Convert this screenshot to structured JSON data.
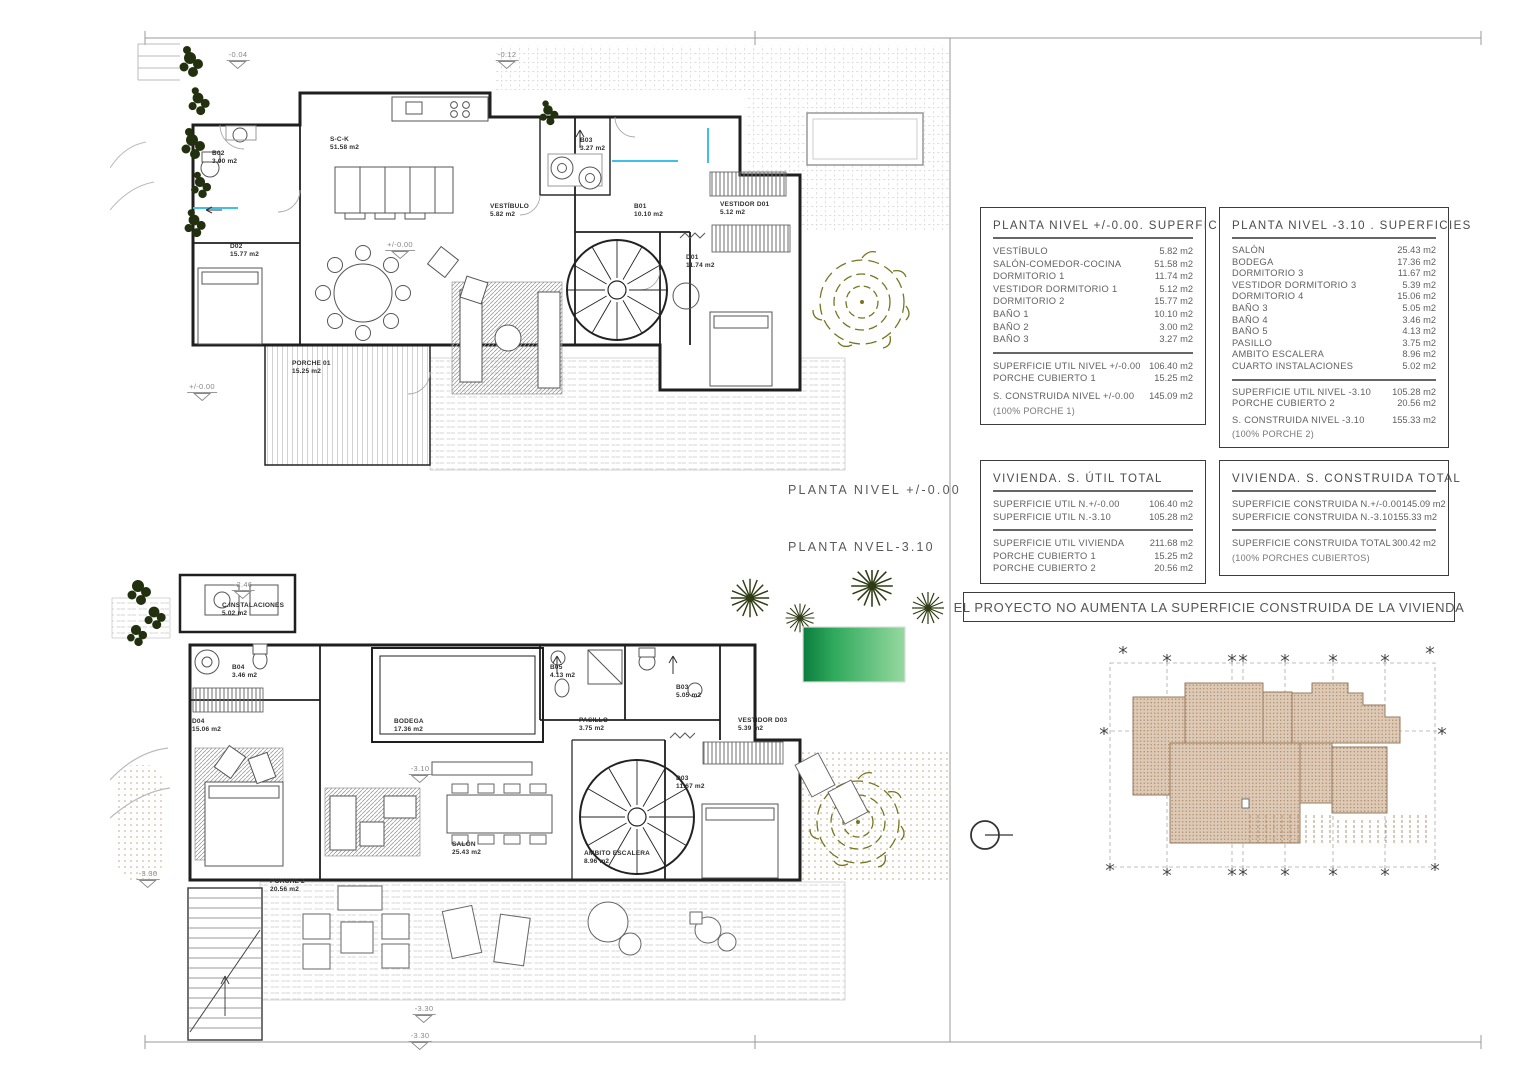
{
  "titles": {
    "upper_plan": "PLANTA NIVEL +/-0.00",
    "lower_plan": "PLANTA NVEL-3.10"
  },
  "banner": "EL PROYECTO NO AUMENTA LA SUPERFICIE CONSTRUIDA DE LA VIVIENDA",
  "colors": {
    "accent_cyan": "#3fc1e6",
    "pool_dark": "#0b7d3c",
    "pool_light": "#97d9a0",
    "plant_olive": "#76761f",
    "roof_tan": "#dcc9b6",
    "roof_dot": "#b08968",
    "sand": "#c5a478",
    "wall": "#1f1f1f"
  },
  "tables": {
    "t1": {
      "title": "PLANTA NIVEL +/-0.00. SUPERFICIES",
      "rows": [
        {
          "label": "VESTÍBULO",
          "value": "5.82 m2"
        },
        {
          "label": "SALÓN-COMEDOR-COCINA",
          "value": "51.58 m2"
        },
        {
          "label": "DORMITORIO 1",
          "value": "11.74 m2"
        },
        {
          "label": "VESTIDOR DORMITORIO 1",
          "value": "5.12 m2"
        },
        {
          "label": "DORMITORIO 2",
          "value": "15.77 m2"
        },
        {
          "label": "BAÑO 1",
          "value": "10.10 m2"
        },
        {
          "label": "BAÑO 2",
          "value": "3.00 m2"
        },
        {
          "label": "BAÑO 3",
          "value": "3.27 m2"
        }
      ],
      "summary": [
        {
          "label": "SUPERFICIE UTIL NIVEL +/-0.00",
          "value": "106.40 m2"
        },
        {
          "label": "PORCHE CUBIERTO 1",
          "value": "15.25 m2"
        }
      ],
      "total": {
        "label": "S. CONSTRUIDA NIVEL +/-0.00",
        "value": "145.09 m2"
      },
      "note": "(100% PORCHE 1)"
    },
    "t2": {
      "title": "PLANTA NIVEL -3.10 . SUPERFICIES",
      "rows": [
        {
          "label": "SALÓN",
          "value": "25.43 m2"
        },
        {
          "label": "BODEGA",
          "value": "17.36 m2"
        },
        {
          "label": "DORMITORIO 3",
          "value": "11.67 m2"
        },
        {
          "label": "VESTIDOR DORMITORIO 3",
          "value": "5.39 m2"
        },
        {
          "label": "DORMITORIO 4",
          "value": "15.06 m2"
        },
        {
          "label": "BAÑO 3",
          "value": "5.05 m2"
        },
        {
          "label": "BAÑO 4",
          "value": "3.46 m2"
        },
        {
          "label": "BAÑO 5",
          "value": "4.13 m2"
        },
        {
          "label": "PASILLO",
          "value": "3.75 m2"
        },
        {
          "label": "AMBITO ESCALERA",
          "value": "8.96 m2"
        },
        {
          "label": "CUARTO INSTALACIONES",
          "value": "5.02 m2"
        }
      ],
      "summary": [
        {
          "label": "SUPERFICIE UTIL NIVEL -3.10",
          "value": "105.28 m2"
        },
        {
          "label": "PORCHE CUBIERTO 2",
          "value": "20.56 m2"
        }
      ],
      "total": {
        "label": "S. CONSTRUIDA NIVEL -3.10",
        "value": "155.33 m2"
      },
      "note": "(100% PORCHE 2)"
    },
    "t3": {
      "title": "VIVIENDA. S. ÚTIL TOTAL",
      "rows": [
        {
          "label": "SUPERFICIE UTIL N.+/-0.00",
          "value": "106.40 m2"
        },
        {
          "label": "SUPERFICIE UTIL N.-3.10",
          "value": "105.28 m2"
        }
      ],
      "summary": [
        {
          "label": "SUPERFICIE UTIL VIVIENDA",
          "value": "211.68 m2"
        },
        {
          "label": "PORCHE CUBIERTO 1",
          "value": "15.25 m2"
        },
        {
          "label": "PORCHE CUBIERTO 2",
          "value": "20.56 m2"
        }
      ]
    },
    "t4": {
      "title": "VIVIENDA. S. CONSTRUIDA TOTAL",
      "rows": [
        {
          "label": "SUPERFICIE CONSTRUIDA N.+/-0.00",
          "value": "145.09 m2"
        },
        {
          "label": "SUPERFICIE CONSTRUIDA N.-3.10",
          "value": "155.33 m2"
        }
      ],
      "total": {
        "label": "SUPERFICIE CONSTRUIDA TOTAL",
        "value": "300.42 m2"
      },
      "note": "(100% PORCHES CUBIERTOS)"
    }
  },
  "upper_plan": {
    "rooms": [
      {
        "name": "B02",
        "area": "3.00 m2",
        "x": 212,
        "y": 150
      },
      {
        "name": "S-C-K",
        "area": "51.58 m2",
        "x": 330,
        "y": 136
      },
      {
        "name": "D02",
        "area": "15.77 m2",
        "x": 230,
        "y": 243
      },
      {
        "name": "VESTÍBULO",
        "area": "5.82 m2",
        "x": 490,
        "y": 203
      },
      {
        "name": "B03",
        "area": "3.27 m2",
        "x": 580,
        "y": 137
      },
      {
        "name": "B01",
        "area": "10.10 m2",
        "x": 634,
        "y": 203
      },
      {
        "name": "VESTIDOR D01",
        "area": "5.12 m2",
        "x": 720,
        "y": 201
      },
      {
        "name": "D01",
        "area": "11.74 m2",
        "x": 686,
        "y": 254
      },
      {
        "name": "PORCHE 01",
        "area": "15.25 m2",
        "x": 292,
        "y": 360
      }
    ],
    "levels": [
      {
        "v": "-0.04",
        "x": 238,
        "y": 50
      },
      {
        "v": "-0.12",
        "x": 507,
        "y": 50
      },
      {
        "v": "+/-0.00",
        "x": 400,
        "y": 240
      },
      {
        "v": "+/-0.00",
        "x": 202,
        "y": 382
      }
    ]
  },
  "lower_plan": {
    "rooms": [
      {
        "name": "C.INSTALACIONES",
        "area": "5.02 m2",
        "x": 222,
        "y": 602
      },
      {
        "name": "B04",
        "area": "3.46 m2",
        "x": 232,
        "y": 664
      },
      {
        "name": "D04",
        "area": "15.06 m2",
        "x": 192,
        "y": 718
      },
      {
        "name": "BODEGA",
        "area": "17.36 m2",
        "x": 394,
        "y": 718
      },
      {
        "name": "B05",
        "area": "4.13 m2",
        "x": 550,
        "y": 664
      },
      {
        "name": "B03",
        "area": "5.05 m2",
        "x": 676,
        "y": 684
      },
      {
        "name": "PASILLO",
        "area": "3.75 m2",
        "x": 579,
        "y": 717
      },
      {
        "name": "VESTIDOR D03",
        "area": "5.39 m2",
        "x": 738,
        "y": 717
      },
      {
        "name": "SALÓN",
        "area": "25.43 m2",
        "x": 452,
        "y": 841
      },
      {
        "name": "AMBITO ESCALERA",
        "area": "8.96 m2",
        "x": 584,
        "y": 850
      },
      {
        "name": "D03",
        "area": "11.67 m2",
        "x": 676,
        "y": 775
      },
      {
        "name": "PORCHE 2",
        "area": "20.56 m2",
        "x": 270,
        "y": 878
      }
    ],
    "levels": [
      {
        "v": "-2.46",
        "x": 243,
        "y": 580
      },
      {
        "v": "-3.10",
        "x": 420,
        "y": 764
      },
      {
        "v": "-3.30",
        "x": 148,
        "y": 869
      },
      {
        "v": "-3.30",
        "x": 424,
        "y": 1004
      },
      {
        "v": "-3.30",
        "x": 420,
        "y": 1031
      }
    ]
  }
}
